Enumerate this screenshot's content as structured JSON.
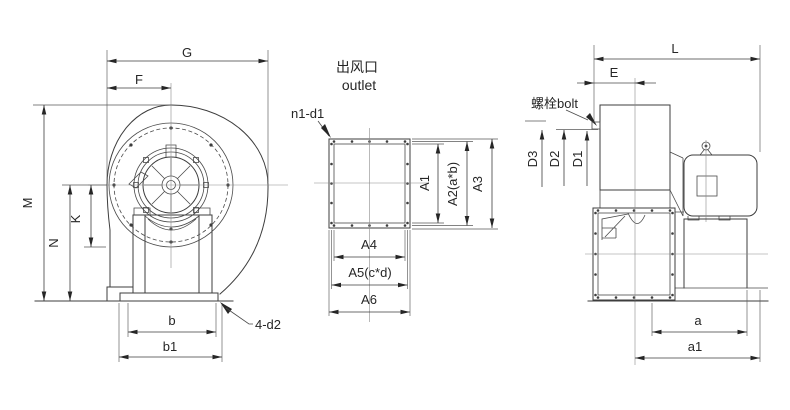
{
  "views": {
    "front": {
      "dims": {
        "G": "G",
        "F": "F",
        "M": "M",
        "N": "N",
        "K": "K",
        "b": "b",
        "b1": "b1"
      },
      "leader_base_holes": "4-d2"
    },
    "outlet": {
      "title_cn": "出风口",
      "title_en": "outlet",
      "leader_flange_holes": "n1-d1",
      "dims": {
        "A1": "A1",
        "A2": "A2(a*b)",
        "A3": "A3",
        "A4": "A4",
        "A5": "A5(c*d)",
        "A6": "A6"
      }
    },
    "side": {
      "leader_bolt": "螺栓bolt",
      "dims": {
        "L": "L",
        "E": "E",
        "D1": "D1",
        "D2": "D2",
        "D3": "D3",
        "a": "a",
        "a1": "a1"
      }
    }
  },
  "colors": {
    "line": "#3d3d3d",
    "centerline": "#8a8a8a",
    "text": "#262626",
    "background": "#ffffff"
  }
}
